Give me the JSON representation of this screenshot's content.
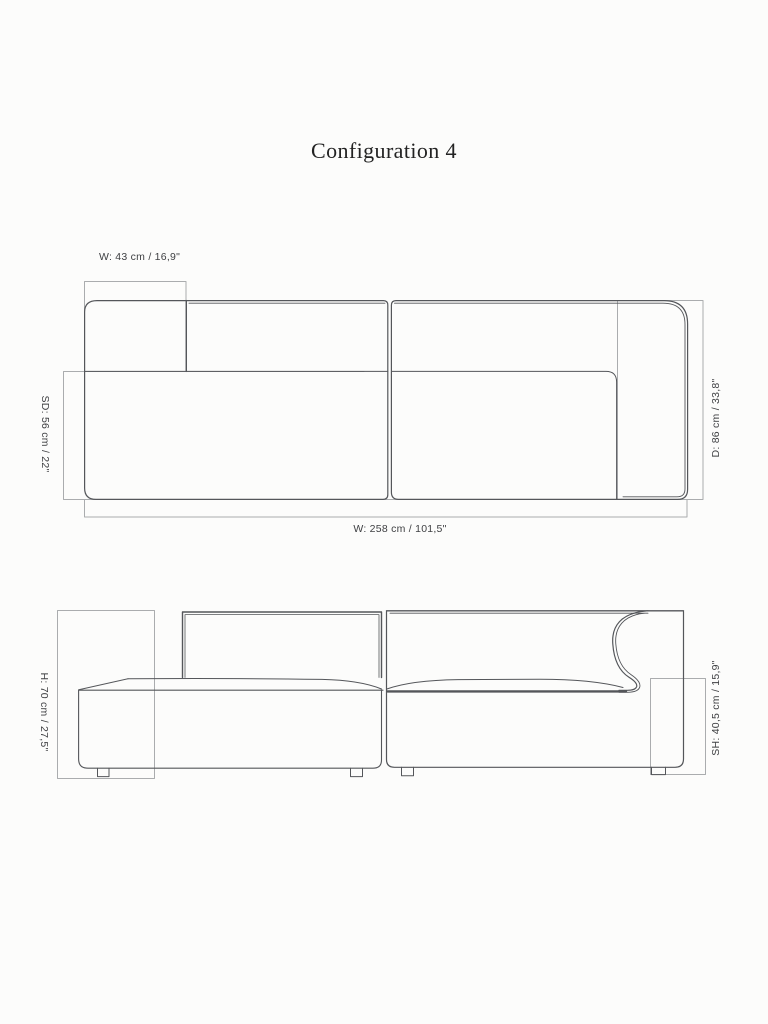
{
  "title": "Configuration 4",
  "plan": {
    "dim_module_width": "W: 43 cm / 16,9\"",
    "dim_seat_depth": "SD: 56 cm / 22\"",
    "dim_depth": "D: 86 cm / 33,8\"",
    "dim_total_width": "W: 258 cm / 101,5\""
  },
  "front": {
    "dim_height": "H: 70 cm / 27,5\"",
    "dim_seat_height": "SH: 40,5 cm / 15,9\""
  },
  "colors": {
    "background": "#fcfcfb",
    "sofa_line": "#54565a",
    "dimension_line": "#aaacae",
    "label_text": "#3f4043",
    "title_text": "#232323"
  }
}
